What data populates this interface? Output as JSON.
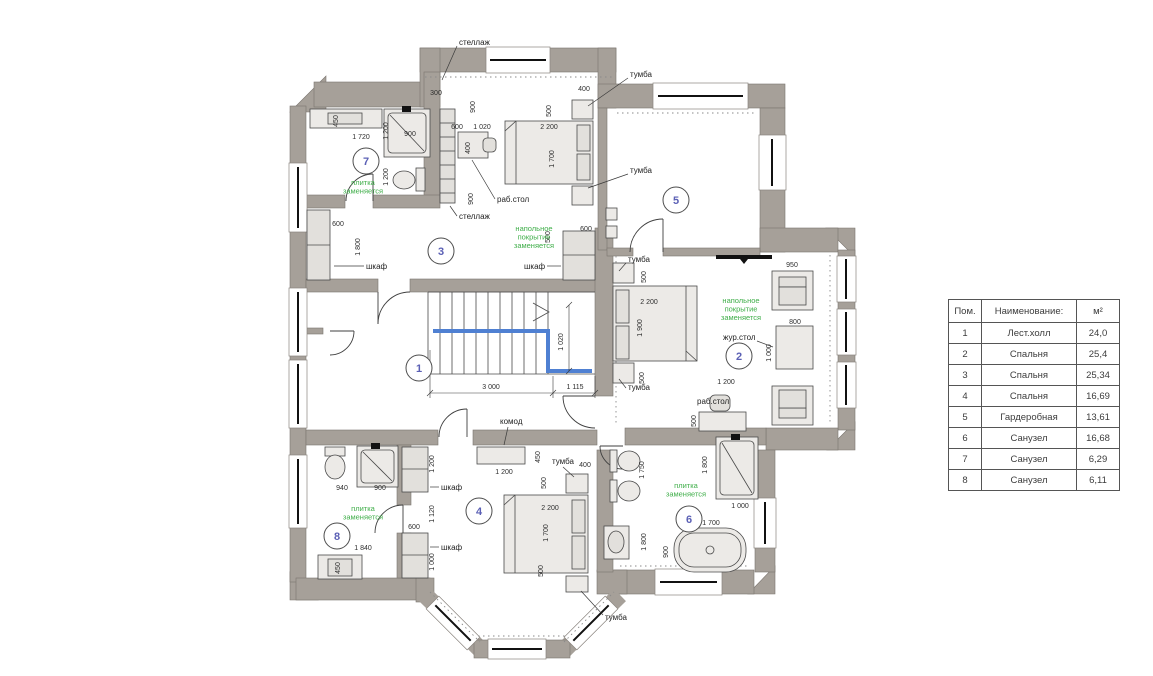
{
  "legend": {
    "headers": [
      "Пом.",
      "Наименование:",
      "м²"
    ],
    "rows": [
      [
        "1",
        "Лест.холл",
        "24,0"
      ],
      [
        "2",
        "Спальня",
        "25,4"
      ],
      [
        "3",
        "Спальня",
        "25,34"
      ],
      [
        "4",
        "Спальня",
        "16,69"
      ],
      [
        "5",
        "Гардеробная",
        "13,61"
      ],
      [
        "6",
        "Санузел",
        "16,68"
      ],
      [
        "7",
        "Санузел",
        "6,29"
      ],
      [
        "8",
        "Санузел",
        "6,11"
      ]
    ]
  },
  "colors": {
    "wall": "#a6a099",
    "note_green": "#3fae49",
    "room_number_blue": "#5b60b5",
    "stair_rail_blue": "#4f80d2"
  },
  "plan": {
    "rooms": [
      {
        "num": "1",
        "name": "Лест.холл"
      },
      {
        "num": "2",
        "name": "Спальня"
      },
      {
        "num": "3",
        "name": "Спальня"
      },
      {
        "num": "4",
        "name": "Спальня"
      },
      {
        "num": "5",
        "name": "Гардеробная"
      },
      {
        "num": "6",
        "name": "Санузел"
      },
      {
        "num": "7",
        "name": "Санузел"
      },
      {
        "num": "8",
        "name": "Санузел"
      }
    ],
    "circles": [
      {
        "n": "1",
        "x": 419,
        "y": 368
      },
      {
        "n": "2",
        "x": 739,
        "y": 356
      },
      {
        "n": "3",
        "x": 441,
        "y": 251
      },
      {
        "n": "4",
        "x": 479,
        "y": 511
      },
      {
        "n": "5",
        "x": 676,
        "y": 200
      },
      {
        "n": "6",
        "x": 689,
        "y": 519
      },
      {
        "n": "7",
        "x": 366,
        "y": 161
      },
      {
        "n": "8",
        "x": 337,
        "y": 536
      }
    ],
    "green_notes": [
      {
        "lines": [
          "плитка",
          "заменяется"
        ],
        "x": 363,
        "y": 185
      },
      {
        "lines": [
          "плитка",
          "заменяется"
        ],
        "x": 363,
        "y": 511
      },
      {
        "lines": [
          "плитка",
          "заменяется"
        ],
        "x": 686,
        "y": 488
      },
      {
        "lines": [
          "напольное",
          "покрытие",
          "заменяется"
        ],
        "x": 534,
        "y": 231
      },
      {
        "lines": [
          "напольное",
          "покрытие",
          "заменяется"
        ],
        "x": 741,
        "y": 303
      }
    ],
    "furn_labels": [
      {
        "t": "стеллаж",
        "x": 459,
        "y": 45,
        "lead": [
          457,
          46,
          442,
          80
        ]
      },
      {
        "t": "стеллаж",
        "x": 459,
        "y": 219,
        "lead": [
          457,
          216,
          450,
          206
        ]
      },
      {
        "t": "тумба",
        "x": 630,
        "y": 77,
        "lead": [
          628,
          78,
          588,
          106
        ]
      },
      {
        "t": "тумба",
        "x": 630,
        "y": 173,
        "lead": [
          628,
          174,
          588,
          188
        ]
      },
      {
        "t": "тумба",
        "x": 628,
        "y": 262,
        "lead": [
          626,
          263,
          619,
          271
        ]
      },
      {
        "t": "тумба",
        "x": 628,
        "y": 390,
        "lead": [
          626,
          388,
          619,
          379
        ]
      },
      {
        "t": "раб.стол",
        "x": 497,
        "y": 202,
        "lead": [
          495,
          199,
          472,
          160
        ]
      },
      {
        "t": "раб.стол",
        "x": 697,
        "y": 404
      },
      {
        "t": "жур.стол",
        "x": 723,
        "y": 340,
        "lead": [
          757,
          341,
          773,
          347
        ]
      },
      {
        "t": "шкаф",
        "x": 366,
        "y": 269,
        "lead": [
          364,
          266,
          334,
          266
        ]
      },
      {
        "t": "шкаф",
        "x": 524,
        "y": 269,
        "lead": [
          547,
          266,
          561,
          266
        ]
      },
      {
        "t": "шкаф",
        "x": 441,
        "y": 490,
        "lead": [
          439,
          487,
          430,
          487
        ]
      },
      {
        "t": "шкаф",
        "x": 441,
        "y": 550,
        "lead": [
          439,
          547,
          430,
          547
        ]
      },
      {
        "t": "комод",
        "x": 500,
        "y": 424,
        "lead": [
          508,
          427,
          504,
          445
        ]
      },
      {
        "t": "тумба",
        "x": 552,
        "y": 464,
        "lead": [
          563,
          467,
          574,
          477
        ]
      },
      {
        "t": "тумба",
        "x": 605,
        "y": 620,
        "lead": [
          603,
          615,
          581,
          591
        ]
      }
    ],
    "dims": [
      {
        "t": "450",
        "x": 338,
        "y": 121,
        "v": 1
      },
      {
        "t": "1 720",
        "x": 361,
        "y": 139
      },
      {
        "t": "1 200",
        "x": 388,
        "y": 131,
        "v": 1
      },
      {
        "t": "900",
        "x": 410,
        "y": 136
      },
      {
        "t": "1 200",
        "x": 388,
        "y": 177,
        "v": 1
      },
      {
        "t": "600",
        "x": 338,
        "y": 226
      },
      {
        "t": "1 800",
        "x": 360,
        "y": 247,
        "v": 1
      },
      {
        "t": "300",
        "x": 436,
        "y": 95
      },
      {
        "t": "900",
        "x": 475,
        "y": 107,
        "v": 1
      },
      {
        "t": "600",
        "x": 457,
        "y": 129
      },
      {
        "t": "1 020",
        "x": 482,
        "y": 129
      },
      {
        "t": "400",
        "x": 470,
        "y": 148,
        "v": 1
      },
      {
        "t": "2 200",
        "x": 549,
        "y": 129
      },
      {
        "t": "500",
        "x": 551,
        "y": 111,
        "v": 1
      },
      {
        "t": "1 700",
        "x": 554,
        "y": 159,
        "v": 1
      },
      {
        "t": "400",
        "x": 584,
        "y": 91
      },
      {
        "t": "900",
        "x": 473,
        "y": 199,
        "v": 1
      },
      {
        "t": "500",
        "x": 550,
        "y": 237,
        "v": 1
      },
      {
        "t": "600",
        "x": 586,
        "y": 231
      },
      {
        "t": "500",
        "x": 646,
        "y": 277,
        "v": 1
      },
      {
        "t": "2 200",
        "x": 649,
        "y": 304
      },
      {
        "t": "1 900",
        "x": 642,
        "y": 328,
        "v": 1
      },
      {
        "t": "500",
        "x": 644,
        "y": 378,
        "v": 1
      },
      {
        "t": "950",
        "x": 792,
        "y": 267
      },
      {
        "t": "800",
        "x": 795,
        "y": 324
      },
      {
        "t": "1 000",
        "x": 771,
        "y": 353,
        "v": 1
      },
      {
        "t": "1 200",
        "x": 726,
        "y": 384
      },
      {
        "t": "500",
        "x": 696,
        "y": 421,
        "v": 1
      },
      {
        "t": "3 000",
        "x": 491,
        "y": 389
      },
      {
        "t": "1 115",
        "x": 575,
        "y": 389
      },
      {
        "t": "1 020",
        "x": 563,
        "y": 342,
        "v": 1
      },
      {
        "t": "1 200",
        "x": 434,
        "y": 464,
        "v": 1
      },
      {
        "t": "1 120",
        "x": 434,
        "y": 514,
        "v": 1
      },
      {
        "t": "1 000",
        "x": 434,
        "y": 562,
        "v": 1
      },
      {
        "t": "600",
        "x": 414,
        "y": 529
      },
      {
        "t": "940",
        "x": 342,
        "y": 490
      },
      {
        "t": "900",
        "x": 380,
        "y": 490
      },
      {
        "t": "1 840",
        "x": 363,
        "y": 550
      },
      {
        "t": "450",
        "x": 340,
        "y": 568,
        "v": 1
      },
      {
        "t": "1 200",
        "x": 504,
        "y": 474
      },
      {
        "t": "450",
        "x": 540,
        "y": 457,
        "v": 1
      },
      {
        "t": "400",
        "x": 585,
        "y": 467
      },
      {
        "t": "500",
        "x": 546,
        "y": 483,
        "v": 1
      },
      {
        "t": "2 200",
        "x": 550,
        "y": 510
      },
      {
        "t": "1 700",
        "x": 548,
        "y": 533,
        "v": 1
      },
      {
        "t": "500",
        "x": 543,
        "y": 571,
        "v": 1
      },
      {
        "t": "1 750",
        "x": 644,
        "y": 470,
        "v": 1
      },
      {
        "t": "1 800",
        "x": 707,
        "y": 465,
        "v": 1
      },
      {
        "t": "1 000",
        "x": 740,
        "y": 508
      },
      {
        "t": "1 700",
        "x": 711,
        "y": 525
      },
      {
        "t": "900",
        "x": 668,
        "y": 552,
        "v": 1
      },
      {
        "t": "1 800",
        "x": 646,
        "y": 542,
        "v": 1
      }
    ]
  }
}
